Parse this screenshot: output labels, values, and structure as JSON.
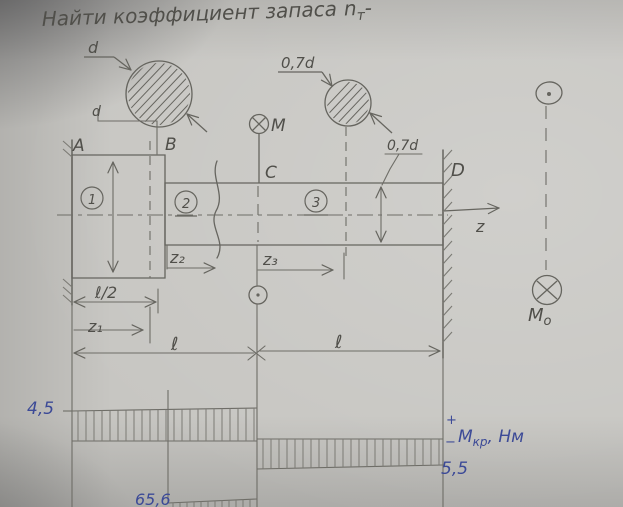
{
  "title": {
    "text": "Найти коэффициент запаса",
    "var": "n",
    "sub": "т",
    "tail": "-"
  },
  "points": {
    "a": "A",
    "b": "B",
    "c": "C",
    "d": "D"
  },
  "sections": {
    "s1": "1",
    "s2": "2",
    "s3": "3"
  },
  "diameters": {
    "large_leader": "d",
    "large_dim": "d",
    "small_leader": "0,7d",
    "small_dim": "0,7d"
  },
  "moments": {
    "m": "M",
    "mo_base": "M",
    "mo_sub": "o"
  },
  "axis": {
    "z": "z"
  },
  "dims": {
    "half_l": "ℓ/2",
    "z1": "z₁",
    "z2": "z₂",
    "z3": "z₃",
    "l_left": "ℓ",
    "l_right": "ℓ"
  },
  "torque_diagram": {
    "positive": "4,5",
    "negative": "5,5",
    "peak": "65,6",
    "plus": "+",
    "minus": "−",
    "axis_m": "М",
    "axis_sub": "кр",
    "axis_units": ", Нм"
  },
  "colors": {
    "pencil": "#5c5b55",
    "ink": "#3c4a97"
  },
  "chart_data": {
    "type": "area",
    "title": "Мкр, Нм — torque diagram along shaft",
    "x_sections": [
      "A–C",
      "C–D"
    ],
    "values": [
      4.5,
      -5.5
    ],
    "lower_diagram_value_partial": 65.6,
    "units": "Нм"
  }
}
